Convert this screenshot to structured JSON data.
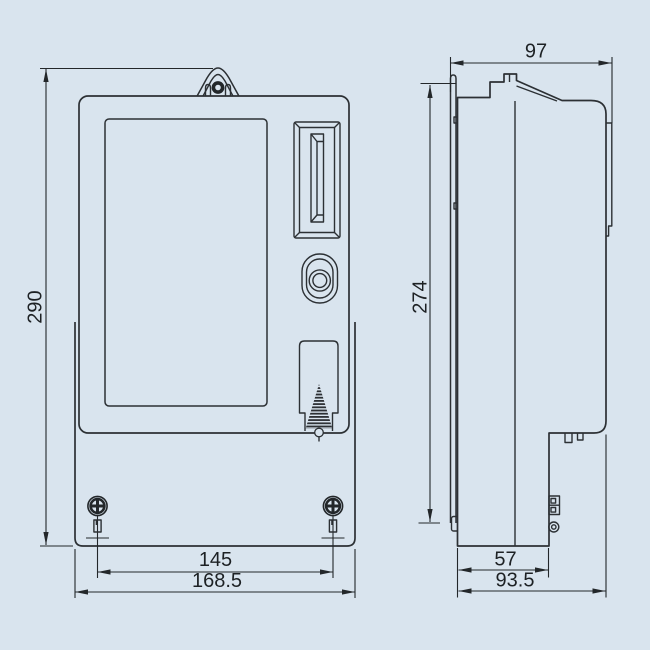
{
  "diagram": {
    "colors": {
      "background": "#d9e4ee",
      "line": "#2c3034",
      "text": "#1d2124"
    },
    "front_view": {
      "dim_total_height": "290",
      "dim_mounting_hole_spacing": "145",
      "dim_total_width": "168.5"
    },
    "side_view": {
      "dim_top_depth": "97",
      "dim_mounting_height": "274",
      "dim_terminal_depth": "57",
      "dim_overall_depth": "93.5"
    }
  }
}
